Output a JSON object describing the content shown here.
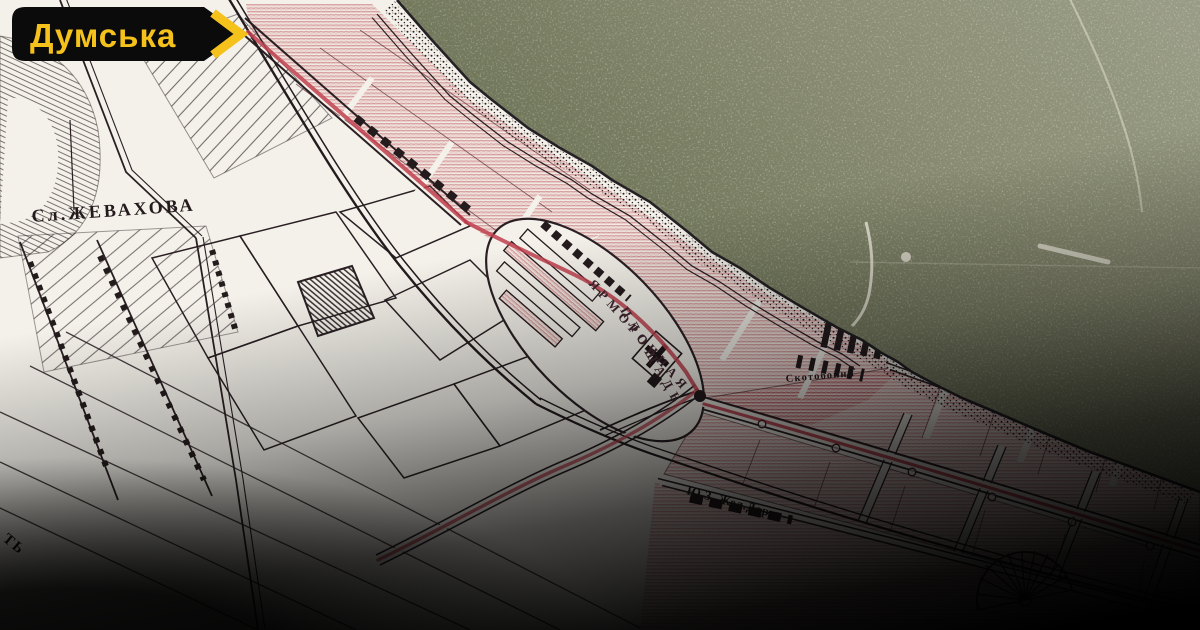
{
  "badge": {
    "label": "Думська",
    "background": "#0b0b0b",
    "accent": "#f4c21b"
  },
  "map": {
    "labels": {
      "settlement": "Сл.ЖЕВАХОВА",
      "fair_square_line1": "ЯРМОРОЧНАЯ",
      "fair_square_line2": "ПЛОЩАДЬ",
      "railway": "Ю.З. Жел.Дор.",
      "slaughterhouses": "Скотобойни",
      "edge_fragment": "ТЬ"
    },
    "colors": {
      "sea": "#7a7e62",
      "paper": "#f4f1ea",
      "ink": "#2a2024",
      "route_red": "#bf3f4e",
      "hatch_red": "#b93e48"
    }
  }
}
